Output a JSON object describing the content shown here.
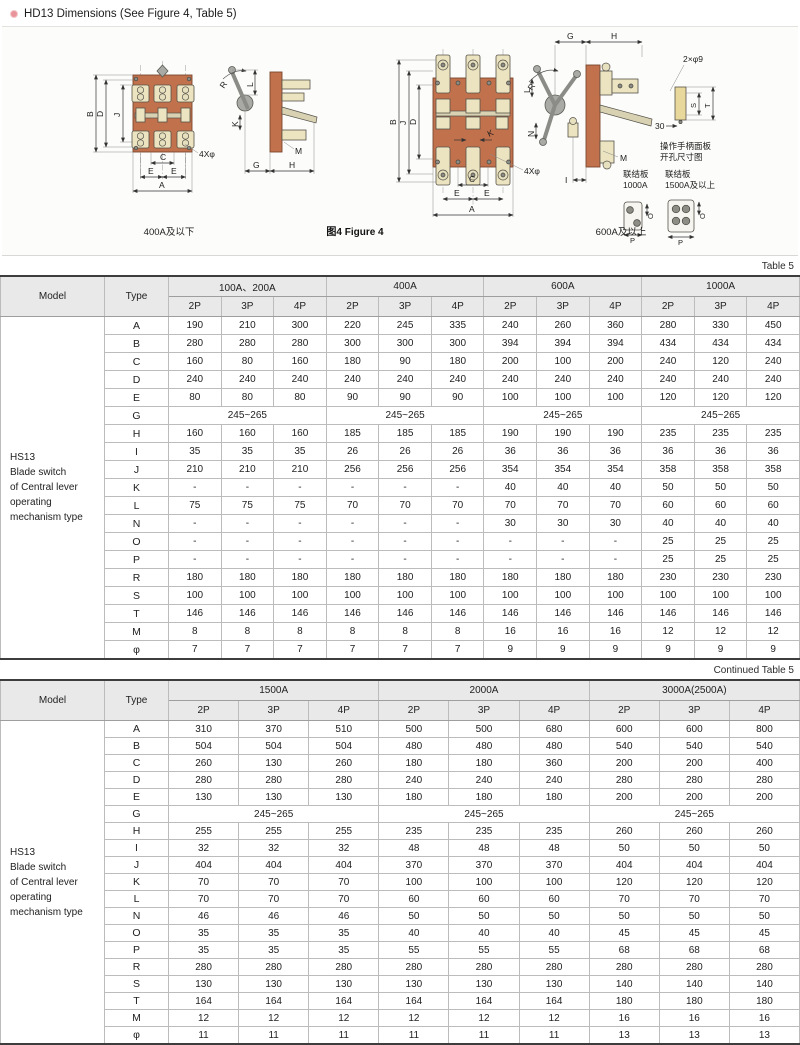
{
  "page": {
    "title": "HD13 Dimensions (See Figure 4, Table 5)"
  },
  "figure": {
    "caption_left": "400A及以下",
    "caption_center": "图4 Figure 4",
    "caption_right": "600A及以上",
    "panel_note1": "操作手柄面板",
    "panel_note2": "开孔尺寸图",
    "plate1_line1": "联结板",
    "plate1_line2": "1000A",
    "plate2_line1": "联结板",
    "plate2_line2": "1500A及以上",
    "dims": {
      "A": "A",
      "B": "B",
      "C": "C",
      "D": "D",
      "E": "E",
      "G": "G",
      "H": "H",
      "I": "I",
      "J": "J",
      "K": "K",
      "L": "L",
      "M": "M",
      "N": "N",
      "O": "O",
      "P": "P",
      "R": "R",
      "S": "S",
      "T": "T",
      "bolt": "4Xφ",
      "holes": "2×φ9",
      "offset30": "30"
    }
  },
  "tables": [
    {
      "tag": "Table 5",
      "model_header": "Model",
      "type_header": "Type",
      "model_lines": [
        "HS13",
        "Blade switch",
        "of Central lever",
        "operating",
        "mechanism type"
      ],
      "groups": [
        "100A、200A",
        "400A",
        "600A",
        "1000A"
      ],
      "subcols": [
        "2P",
        "3P",
        "4P"
      ],
      "rows": [
        {
          "type": "A",
          "values": [
            "190",
            "210",
            "300",
            "220",
            "245",
            "335",
            "240",
            "260",
            "360",
            "280",
            "330",
            "450"
          ]
        },
        {
          "type": "B",
          "values": [
            "280",
            "280",
            "280",
            "300",
            "300",
            "300",
            "394",
            "394",
            "394",
            "434",
            "434",
            "434"
          ]
        },
        {
          "type": "C",
          "values": [
            "160",
            "80",
            "160",
            "180",
            "90",
            "180",
            "200",
            "100",
            "200",
            "240",
            "120",
            "240"
          ]
        },
        {
          "type": "D",
          "values": [
            "240",
            "240",
            "240",
            "240",
            "240",
            "240",
            "240",
            "240",
            "240",
            "240",
            "240",
            "240"
          ]
        },
        {
          "type": "E",
          "values": [
            "80",
            "80",
            "80",
            "90",
            "90",
            "90",
            "100",
            "100",
            "100",
            "120",
            "120",
            "120"
          ]
        },
        {
          "type": "G",
          "merged": "245~265"
        },
        {
          "type": "H",
          "values": [
            "160",
            "160",
            "160",
            "185",
            "185",
            "185",
            "190",
            "190",
            "190",
            "235",
            "235",
            "235"
          ]
        },
        {
          "type": "I",
          "values": [
            "35",
            "35",
            "35",
            "26",
            "26",
            "26",
            "36",
            "36",
            "36",
            "36",
            "36",
            "36"
          ]
        },
        {
          "type": "J",
          "values": [
            "210",
            "210",
            "210",
            "256",
            "256",
            "256",
            "354",
            "354",
            "354",
            "358",
            "358",
            "358"
          ]
        },
        {
          "type": "K",
          "values": [
            "-",
            "-",
            "-",
            "-",
            "-",
            "-",
            "40",
            "40",
            "40",
            "50",
            "50",
            "50"
          ]
        },
        {
          "type": "L",
          "values": [
            "75",
            "75",
            "75",
            "70",
            "70",
            "70",
            "70",
            "70",
            "70",
            "60",
            "60",
            "60"
          ]
        },
        {
          "type": "N",
          "values": [
            "-",
            "-",
            "-",
            "-",
            "-",
            "-",
            "30",
            "30",
            "30",
            "40",
            "40",
            "40"
          ]
        },
        {
          "type": "O",
          "values": [
            "-",
            "-",
            "-",
            "-",
            "-",
            "-",
            "-",
            "-",
            "-",
            "25",
            "25",
            "25"
          ]
        },
        {
          "type": "P",
          "values": [
            "-",
            "-",
            "-",
            "-",
            "-",
            "-",
            "-",
            "-",
            "-",
            "25",
            "25",
            "25"
          ]
        },
        {
          "type": "R",
          "values": [
            "180",
            "180",
            "180",
            "180",
            "180",
            "180",
            "180",
            "180",
            "180",
            "230",
            "230",
            "230"
          ]
        },
        {
          "type": "S",
          "values": [
            "100",
            "100",
            "100",
            "100",
            "100",
            "100",
            "100",
            "100",
            "100",
            "100",
            "100",
            "100"
          ]
        },
        {
          "type": "T",
          "values": [
            "146",
            "146",
            "146",
            "146",
            "146",
            "146",
            "146",
            "146",
            "146",
            "146",
            "146",
            "146"
          ]
        },
        {
          "type": "M",
          "values": [
            "8",
            "8",
            "8",
            "8",
            "8",
            "8",
            "16",
            "16",
            "16",
            "12",
            "12",
            "12"
          ]
        },
        {
          "type": "φ",
          "values": [
            "7",
            "7",
            "7",
            "7",
            "7",
            "7",
            "9",
            "9",
            "9",
            "9",
            "9",
            "9"
          ]
        }
      ]
    },
    {
      "tag": "Continued Table 5",
      "model_header": "Model",
      "type_header": "Type",
      "model_lines": [
        "HS13",
        "Blade switch",
        "of Central lever",
        "operating",
        "mechanism type"
      ],
      "groups": [
        "1500A",
        "2000A",
        "3000A(2500A)"
      ],
      "subcols": [
        "2P",
        "3P",
        "4P"
      ],
      "rows": [
        {
          "type": "A",
          "values": [
            "310",
            "370",
            "510",
            "500",
            "500",
            "680",
            "600",
            "600",
            "800"
          ]
        },
        {
          "type": "B",
          "values": [
            "504",
            "504",
            "504",
            "480",
            "480",
            "480",
            "540",
            "540",
            "540"
          ]
        },
        {
          "type": "C",
          "values": [
            "260",
            "130",
            "260",
            "180",
            "180",
            "360",
            "200",
            "200",
            "400"
          ]
        },
        {
          "type": "D",
          "values": [
            "280",
            "280",
            "280",
            "240",
            "240",
            "240",
            "280",
            "280",
            "280"
          ]
        },
        {
          "type": "E",
          "values": [
            "130",
            "130",
            "130",
            "180",
            "180",
            "180",
            "200",
            "200",
            "200"
          ]
        },
        {
          "type": "G",
          "merged": "245~265"
        },
        {
          "type": "H",
          "values": [
            "255",
            "255",
            "255",
            "235",
            "235",
            "235",
            "260",
            "260",
            "260"
          ]
        },
        {
          "type": "I",
          "values": [
            "32",
            "32",
            "32",
            "48",
            "48",
            "48",
            "50",
            "50",
            "50"
          ]
        },
        {
          "type": "J",
          "values": [
            "404",
            "404",
            "404",
            "370",
            "370",
            "370",
            "404",
            "404",
            "404"
          ]
        },
        {
          "type": "K",
          "values": [
            "70",
            "70",
            "70",
            "100",
            "100",
            "100",
            "120",
            "120",
            "120"
          ]
        },
        {
          "type": "L",
          "values": [
            "70",
            "70",
            "70",
            "60",
            "60",
            "60",
            "70",
            "70",
            "70"
          ]
        },
        {
          "type": "N",
          "values": [
            "46",
            "46",
            "46",
            "50",
            "50",
            "50",
            "50",
            "50",
            "50"
          ]
        },
        {
          "type": "O",
          "values": [
            "35",
            "35",
            "35",
            "40",
            "40",
            "40",
            "45",
            "45",
            "45"
          ]
        },
        {
          "type": "P",
          "values": [
            "35",
            "35",
            "35",
            "55",
            "55",
            "55",
            "68",
            "68",
            "68"
          ]
        },
        {
          "type": "R",
          "values": [
            "280",
            "280",
            "280",
            "280",
            "280",
            "280",
            "280",
            "280",
            "280"
          ]
        },
        {
          "type": "S",
          "values": [
            "130",
            "130",
            "130",
            "130",
            "130",
            "130",
            "140",
            "140",
            "140"
          ]
        },
        {
          "type": "T",
          "values": [
            "164",
            "164",
            "164",
            "164",
            "164",
            "164",
            "180",
            "180",
            "180"
          ]
        },
        {
          "type": "M",
          "values": [
            "12",
            "12",
            "12",
            "12",
            "12",
            "12",
            "16",
            "16",
            "16"
          ]
        },
        {
          "type": "φ",
          "values": [
            "11",
            "11",
            "11",
            "11",
            "11",
            "11",
            "13",
            "13",
            "13"
          ]
        }
      ]
    }
  ]
}
